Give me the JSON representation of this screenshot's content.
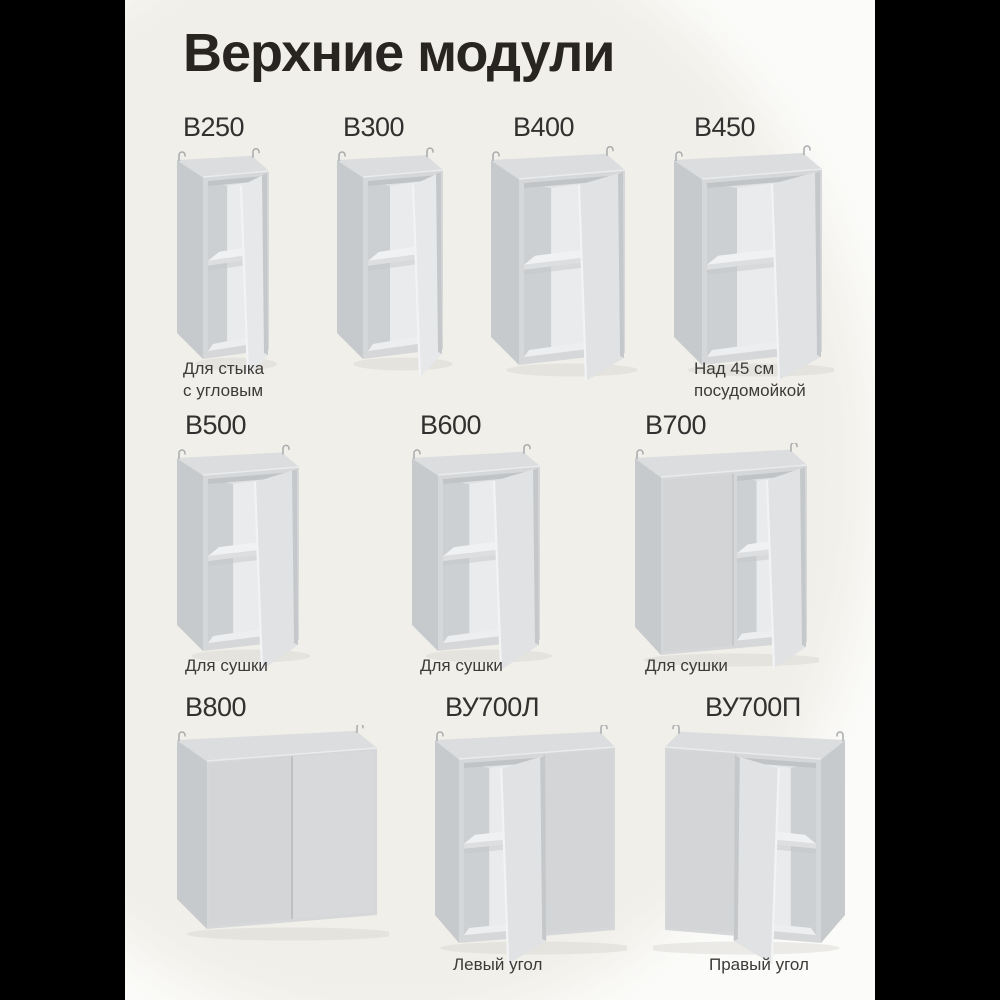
{
  "page": {
    "title": "Верхние модули"
  },
  "modules": [
    {
      "code": "В250",
      "caption": "Для стыка\nс угловым"
    },
    {
      "code": "В300",
      "caption": ""
    },
    {
      "code": "В400",
      "caption": ""
    },
    {
      "code": "В450",
      "caption": "Над 45 см\nпосудомойкой"
    },
    {
      "code": "В500",
      "caption": "Для сушки"
    },
    {
      "code": "В600",
      "caption": "Для сушки"
    },
    {
      "code": "В700",
      "caption": "Для сушки"
    },
    {
      "code": "В800",
      "caption": ""
    },
    {
      "code": "ВУ700Л",
      "caption": "Левый угол"
    },
    {
      "code": "ВУ700П",
      "caption": "Правый угол"
    }
  ],
  "colors": {
    "page_background": "#f1efe9",
    "page_corner_white": "#fbfbf9",
    "pillarbox": "#000000",
    "title_text": "#282421",
    "label_text": "#333130",
    "caption_text": "#3d3b38",
    "cabinet_body": "#d5d7d9",
    "cabinet_side": "#c7cacc",
    "cabinet_interior": "#e9ebec"
  }
}
